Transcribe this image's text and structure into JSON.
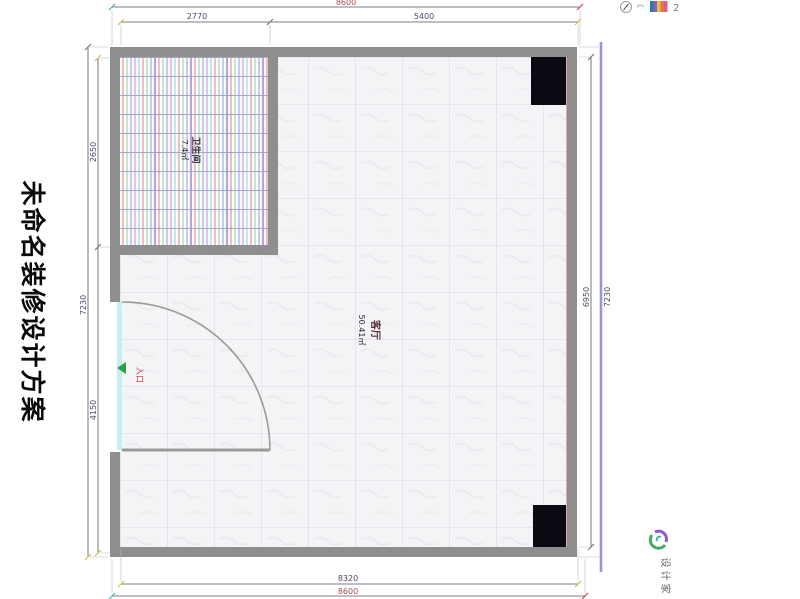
{
  "title": {
    "text": "未命名装修设计方案"
  },
  "plan": {
    "rooms": [
      {
        "id": "bathroom",
        "name": "卫生间",
        "area": "7.4㎡"
      },
      {
        "id": "living-room",
        "name": "客厅",
        "area": "50.41㎡"
      }
    ],
    "entrance": {
      "label": "入口"
    }
  },
  "dimensions": {
    "top": {
      "overall": "8600",
      "segment_left": "2770",
      "segment_right": "5400"
    },
    "bottom": {
      "inner": "8320",
      "outer": "8600"
    },
    "left": {
      "upper": "2650",
      "lower": "4150",
      "overall": "7230"
    },
    "right": {
      "inner": "6950",
      "outer": "7230"
    }
  },
  "header_icons": {
    "scale_value": "2"
  },
  "watermark": {
    "brand": "设计家"
  },
  "colors": {
    "wall": "#8e8e8e",
    "dimension_overall": "#a84848",
    "dimension_segment": "#4a4a66",
    "entrance_red": "#cc3344",
    "arrow_green": "#2e9e44",
    "brand_green": "#3fae5f",
    "brand_purple": "#8a5bd0"
  }
}
